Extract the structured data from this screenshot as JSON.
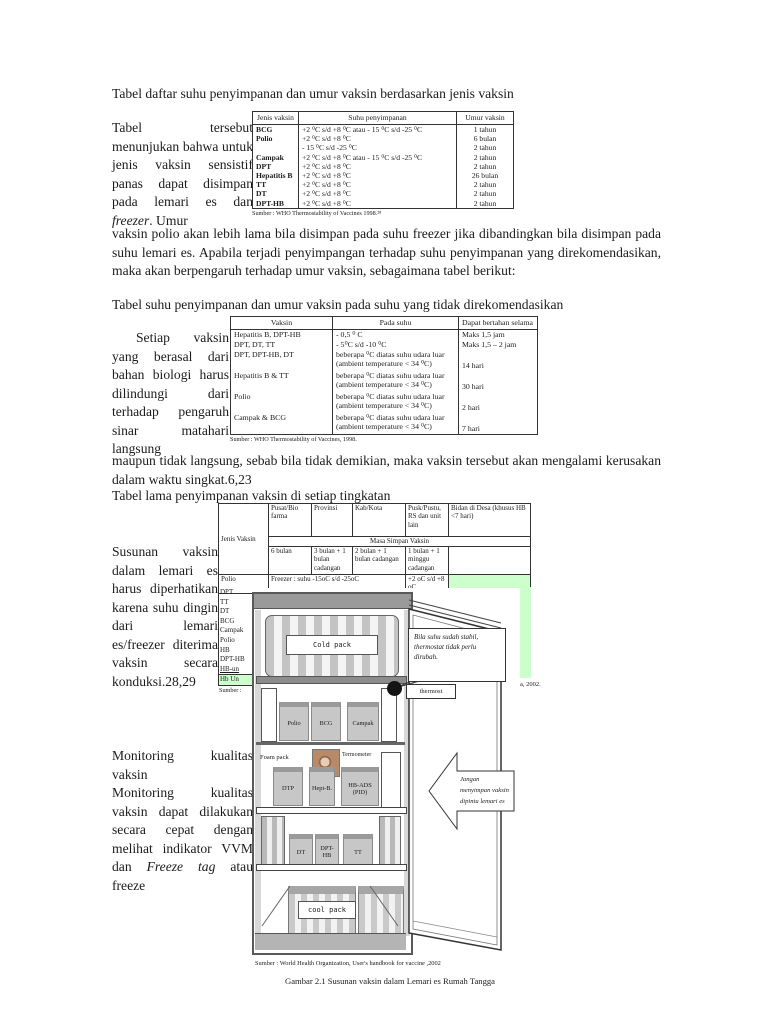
{
  "colors": {
    "highlight_green": "#ccffcc",
    "fridge_gray": "#9a9a9a"
  },
  "text": {
    "title_line": "Tabel daftar suhu penyimpanan dan umur vaksin berdasarkan jenis vaksin",
    "left1_a": "Tabel tersebut menunjukan bahwa untuk jenis vaksin sensistif panas dapat disimpan pada lemari es dan ",
    "left1_b": "freezer",
    "left1_c": ". Umur",
    "para1": "vaksin polio akan lebih lama bila disimpan pada suhu freezer jika dibandingkan bila disimpan pada suhu lemari es. Apabila terjadi penyimpangan terhadap suhu penyimpanan yang direkomendasikan, maka akan berpengaruh terhadap umur vaksin, sebagaimana tabel berikut:",
    "subhead_a": "Tabel suhu penyimpanan dan umur vaksin pada suhu yang tidak direkomendasikan",
    "left2": "Setiap vaksin yang berasal dari bahan biologi harus dilindungi dari terhadap pengaruh sinar matahari langsung",
    "para2": "maupun tidak langsung, sebab bila tidak demikian, maka vaksin tersebut akan mengalami kerusakan dalam waktu singkat.6,23",
    "subhead_b": "Tabel lama penyimpanan vaksin di setiap tingkatan",
    "left3": "Susunan vaksin dalam lemari es harus diperhatikan karena suhu dingin dari lemari es/freezer diterima vaksin secara konduksi.28,29",
    "left4_heading": "Monitoring kualitas vaksin",
    "left4_a": "Monitoring kualitas vaksin dapat dilakukan secara cepat dengan melihat indikator VVM dan ",
    "left4_b": "Freeze tag",
    "left4_c": " atau freeze"
  },
  "table1": {
    "headers": [
      "Jenis vaksin",
      "Suhu penyimpanan",
      "Umur vaksin"
    ],
    "rows": [
      [
        "BCG",
        "+2 ⁰C s/d +8 ⁰C atau - 15 ⁰C s/d -25 ⁰C",
        "1 tahun"
      ],
      [
        "Polio",
        "+2 ⁰C s/d +8 ⁰C",
        "6 bulan"
      ],
      [
        "",
        "- 15 ⁰C s/d -25 ⁰C",
        "2 tahun"
      ],
      [
        "Campak",
        "+2 ⁰C s/d +8 ⁰C atau - 15 ⁰C s/d -25 ⁰C",
        "2 tahun"
      ],
      [
        "DPT",
        "+2 ⁰C s/d +8 ⁰C",
        "2 tahun"
      ],
      [
        "Hepatitis B",
        "+2 ⁰C s/d +8 ⁰C",
        "26 bulan"
      ],
      [
        "TT",
        "+2 ⁰C s/d +8 ⁰C",
        "2 tahun"
      ],
      [
        "DT",
        "+2 ⁰C s/d +8 ⁰C",
        "2 tahun"
      ],
      [
        "DPT-HB",
        "+2 ⁰C s/d +8 ⁰C",
        "2 tahun"
      ]
    ],
    "source": "Sumber : WHO Thermostability of Vaccines 1998.²⁸"
  },
  "table2": {
    "headers": [
      "Vaksin",
      "Pada suhu",
      "Dapat bertahan selama"
    ],
    "rows": [
      [
        "Hepatitis B, DPT-HB",
        "- 0,5 ⁰ C",
        "Maks 1,5 jam"
      ],
      [
        "DPT, DT, TT",
        "- 5⁰C s/d -10 ⁰C",
        "Maks 1,5 – 2 jam"
      ],
      [
        "DPT, DPT-HB, DT",
        "beberapa ⁰C diatas suhu udara luar (ambient temperature < 34 ⁰C)",
        "14 hari"
      ],
      [
        "Hepatitis B & TT",
        "beberapa ⁰C diatas suhu udara luar (ambient temperature < 34 ⁰C)",
        "30 hari"
      ],
      [
        "Polio",
        "beberapa ⁰C diatas suhu udara luar (ambient temperature < 34 ⁰C)",
        "2 hari"
      ],
      [
        "Campak & BCG",
        "beberapa ⁰C diatas suhu udara luar (ambient temperature < 34 ⁰C)",
        "7 hari"
      ]
    ],
    "source": "Sumber : WHO Thermostability of Vaccines, 1998."
  },
  "table3": {
    "col1_header": "Jenis Vaksin",
    "headers": [
      "Pusat/Bio farma",
      "Provinsi",
      "Kab/Kota",
      "Pusk/Pustu, RS dan unit lain",
      "Bidan di Desa (khusus HB <7 hari)"
    ],
    "span_header": "Masa Simpan Vaksin",
    "duration_row": [
      "6 bulan",
      "3 bulan + 1 bulan cadangan",
      "2 bulan + 1 bulan cadangan",
      "1 bulan + 1 minggu cadangan"
    ],
    "polio_label": "Polio",
    "polio_freezer": "Freezer : suhu -15oC s/d -25oC",
    "polio_pusk": "+2 oC s/d +8 oC",
    "vaccine_list": [
      "DPT",
      "TT",
      "DT",
      "BCG",
      "Campak",
      "Polio",
      "HB",
      "DPT-HB",
      "HB-un",
      "Hb Un"
    ],
    "source_left": "Sumber :",
    "source_right": "a, 2002."
  },
  "figure": {
    "cold_pack": "Cold pack",
    "bubble": "Bila suhu sudah stabil, thermostat tidak perlu dirubah.",
    "thermostat_label": "thermost",
    "shelf1": [
      "Polio",
      "BCG",
      "Campak"
    ],
    "foam_pack": "Foam pack",
    "termometer": "Termometer",
    "shelf2": [
      "DTP",
      "Hepi-B.",
      "HB-ADS (PID)"
    ],
    "arrow": [
      "Jangan",
      "menyimpan vaksin",
      "dipintu lemari es"
    ],
    "shelf3": [
      "DT",
      "DPT-HB",
      "TT"
    ],
    "cool_pack": "cool pack",
    "source": "Sumber : World Health Organization, User's handbook for vaccine ,2002",
    "caption": "Gambar 2.1  Susunan vaksin dalam Lemari es  Rumah Tangga"
  }
}
